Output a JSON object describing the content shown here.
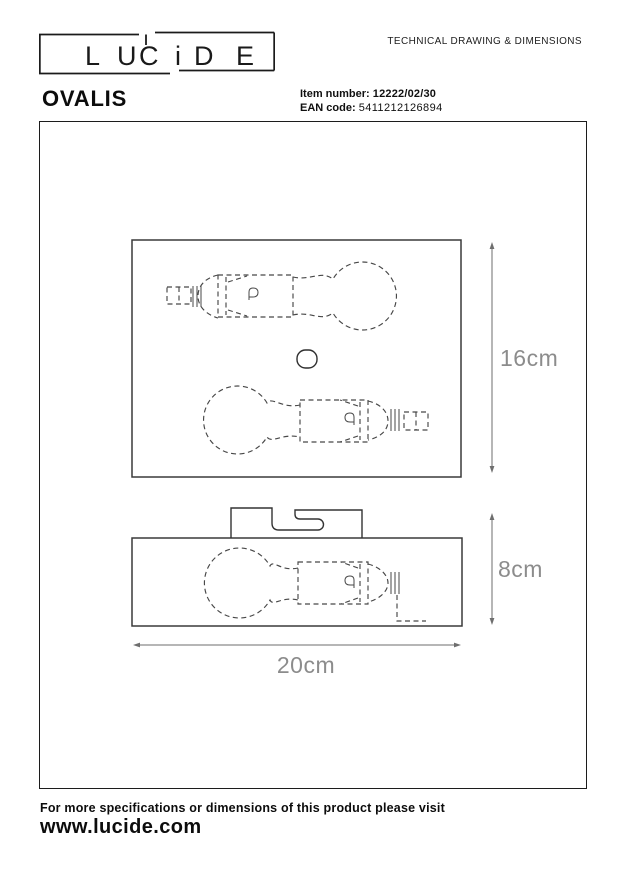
{
  "header": {
    "doc_type": "TECHNICAL DRAWING & DIMENSIONS",
    "logo_letters": [
      "L",
      "U",
      "C",
      "i",
      "D",
      "E"
    ]
  },
  "product": {
    "name": "OVALIS",
    "item_number_label": "Item number:",
    "item_number": "12222/02/30",
    "ean_label": "EAN code:",
    "ean": "5411212126894"
  },
  "drawing": {
    "dim_height_top_view": "16cm",
    "dim_height_front_view": "8cm",
    "dim_width": "20cm"
  },
  "footer": {
    "note": "For more specifications or dimensions of this product please visit",
    "website": "www.lucide.com"
  },
  "colors": {
    "line_dark": "#1c1c1c",
    "line_drawing": "#3d3d3d",
    "line_dim": "#6e6e6e",
    "text_dim": "#8c8c8c"
  }
}
